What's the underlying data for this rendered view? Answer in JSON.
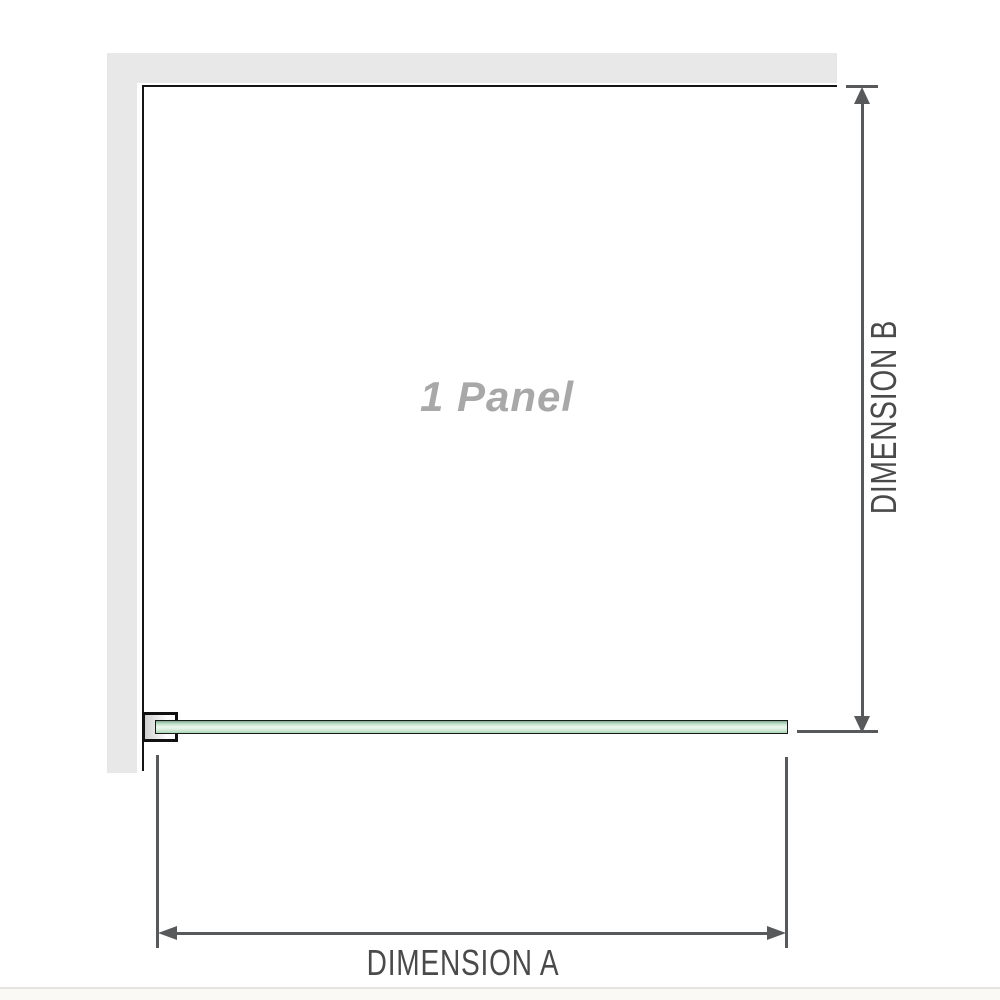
{
  "diagram": {
    "panel_label": "1 Panel",
    "dimension_a": {
      "label": "DIMENSION A",
      "orientation": "horizontal"
    },
    "dimension_b": {
      "label": "DIMENSION B",
      "orientation": "vertical"
    }
  },
  "colors": {
    "background": "#ffffff",
    "wall_fill": "#e8e8e8",
    "panel_outline": "#151515",
    "glass_border": "#1a1a1a",
    "glass_green_dark": "#7fa98d",
    "glass_green_light": "#ecf7ef",
    "glass_green_mid": "#abd7b7",
    "bracket_fill": "#cfcfcf",
    "dimension_line": "#58595b",
    "dimension_text": "#4a4a4a",
    "panel_label_text": "#a8a8a8",
    "footer_divider": "#e3e3df"
  },
  "icons": {
    "arrow_up": "triangle-up",
    "arrow_down": "triangle-down",
    "arrow_left": "triangle-left",
    "arrow_right": "triangle-right"
  }
}
